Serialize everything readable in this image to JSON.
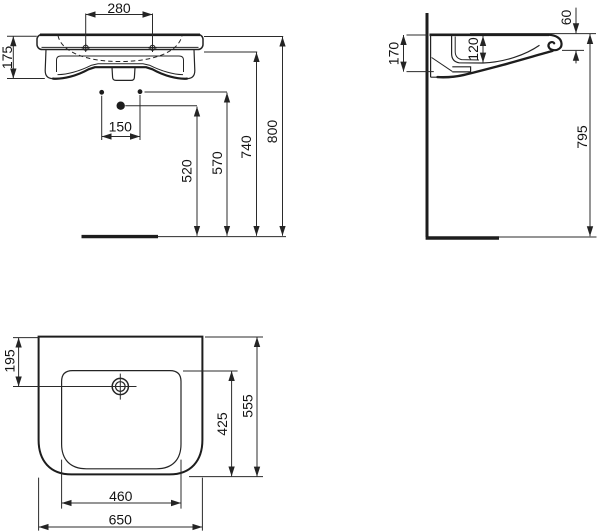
{
  "front": {
    "d280": "280",
    "d175": "175",
    "d150": "150",
    "d520": "520",
    "d570": "570",
    "d740": "740",
    "d800": "800"
  },
  "side": {
    "d170": "170",
    "d120": "120",
    "d60": "60",
    "d795": "795"
  },
  "plan": {
    "d195": "195",
    "d425": "425",
    "d555": "555",
    "d460": "460",
    "d650": "650"
  },
  "colors": {
    "line": "#242424",
    "background": "#ffffff"
  }
}
